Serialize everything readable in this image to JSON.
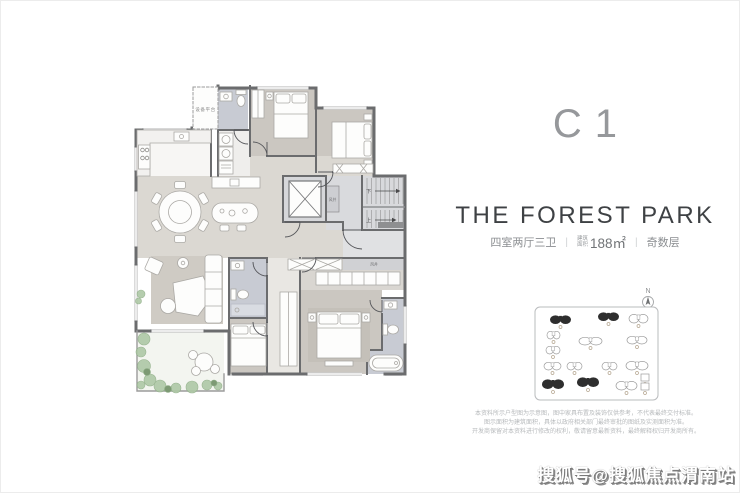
{
  "panel": {
    "unit_code": "C1",
    "title": "THE FOREST PARK",
    "specs": {
      "rooms": "四室两厅三卫",
      "area_label_line1": "建筑",
      "area_label_line2": "面积",
      "area_value": "188㎡",
      "floor": "奇数层",
      "divider": "|"
    },
    "north_label": "N"
  },
  "floor_plan": {
    "labels": {
      "equipment_platform": "设备平台",
      "air_shaft_a": "风井",
      "air_shaft_b": "风井",
      "stairs_down": "下",
      "stairs_up": "上"
    }
  },
  "site_plan": {
    "highlight_color": "#2e2e2e",
    "outline_color": "#9b9b9b",
    "buildings": [
      {
        "x": 550,
        "y": 315,
        "w": 21,
        "h": 9,
        "dark": true,
        "shape": "b"
      },
      {
        "x": 598,
        "y": 312,
        "w": 21,
        "h": 9,
        "dark": true,
        "shape": "b"
      },
      {
        "x": 629,
        "y": 314,
        "w": 19,
        "h": 9,
        "dark": false,
        "shape": "b"
      },
      {
        "x": 547,
        "y": 331,
        "w": 13,
        "h": 8,
        "dark": false,
        "shape": "b"
      },
      {
        "x": 579,
        "y": 337,
        "w": 23,
        "h": 8,
        "dark": false,
        "shape": "b"
      },
      {
        "x": 627,
        "y": 336,
        "w": 20,
        "h": 8,
        "dark": false,
        "shape": "b"
      },
      {
        "x": 546,
        "y": 346,
        "w": 14,
        "h": 8,
        "dark": false,
        "shape": "b"
      },
      {
        "x": 544,
        "y": 362,
        "w": 17,
        "h": 8,
        "dark": false,
        "shape": "b"
      },
      {
        "x": 567,
        "y": 362,
        "w": 15,
        "h": 8,
        "dark": false,
        "shape": "b"
      },
      {
        "x": 602,
        "y": 362,
        "w": 15,
        "h": 8,
        "dark": false,
        "shape": "b"
      },
      {
        "x": 626,
        "y": 361,
        "w": 22,
        "h": 9,
        "dark": false,
        "shape": "b"
      },
      {
        "x": 542,
        "y": 379,
        "w": 22,
        "h": 10,
        "dark": true,
        "shape": "b"
      },
      {
        "x": 577,
        "y": 377,
        "w": 22,
        "h": 10,
        "dark": true,
        "shape": "b"
      },
      {
        "x": 616,
        "y": 381,
        "w": 21,
        "h": 9,
        "dark": false,
        "shape": "b"
      },
      {
        "x": 641,
        "y": 374,
        "w": 8,
        "h": 7,
        "dark": false,
        "shape": "r"
      },
      {
        "x": 641,
        "y": 383,
        "w": 8,
        "h": 7,
        "dark": false,
        "shape": "r"
      }
    ]
  },
  "disclaimer": {
    "line1": "本资料所示户型图为示意图，图中家具布置及装饰仅供参考，不代表最终交付标准。",
    "line2": "图示面积为建筑面积，具体以政府相关部门最终审批的图纸及实测面积为准。",
    "line3": "开发商保留对本资料进行修改的权利，敬请留意最新资料，最终解释权归开发商所有。"
  },
  "watermark": "搜狐号@搜狐焦点渭南站"
}
